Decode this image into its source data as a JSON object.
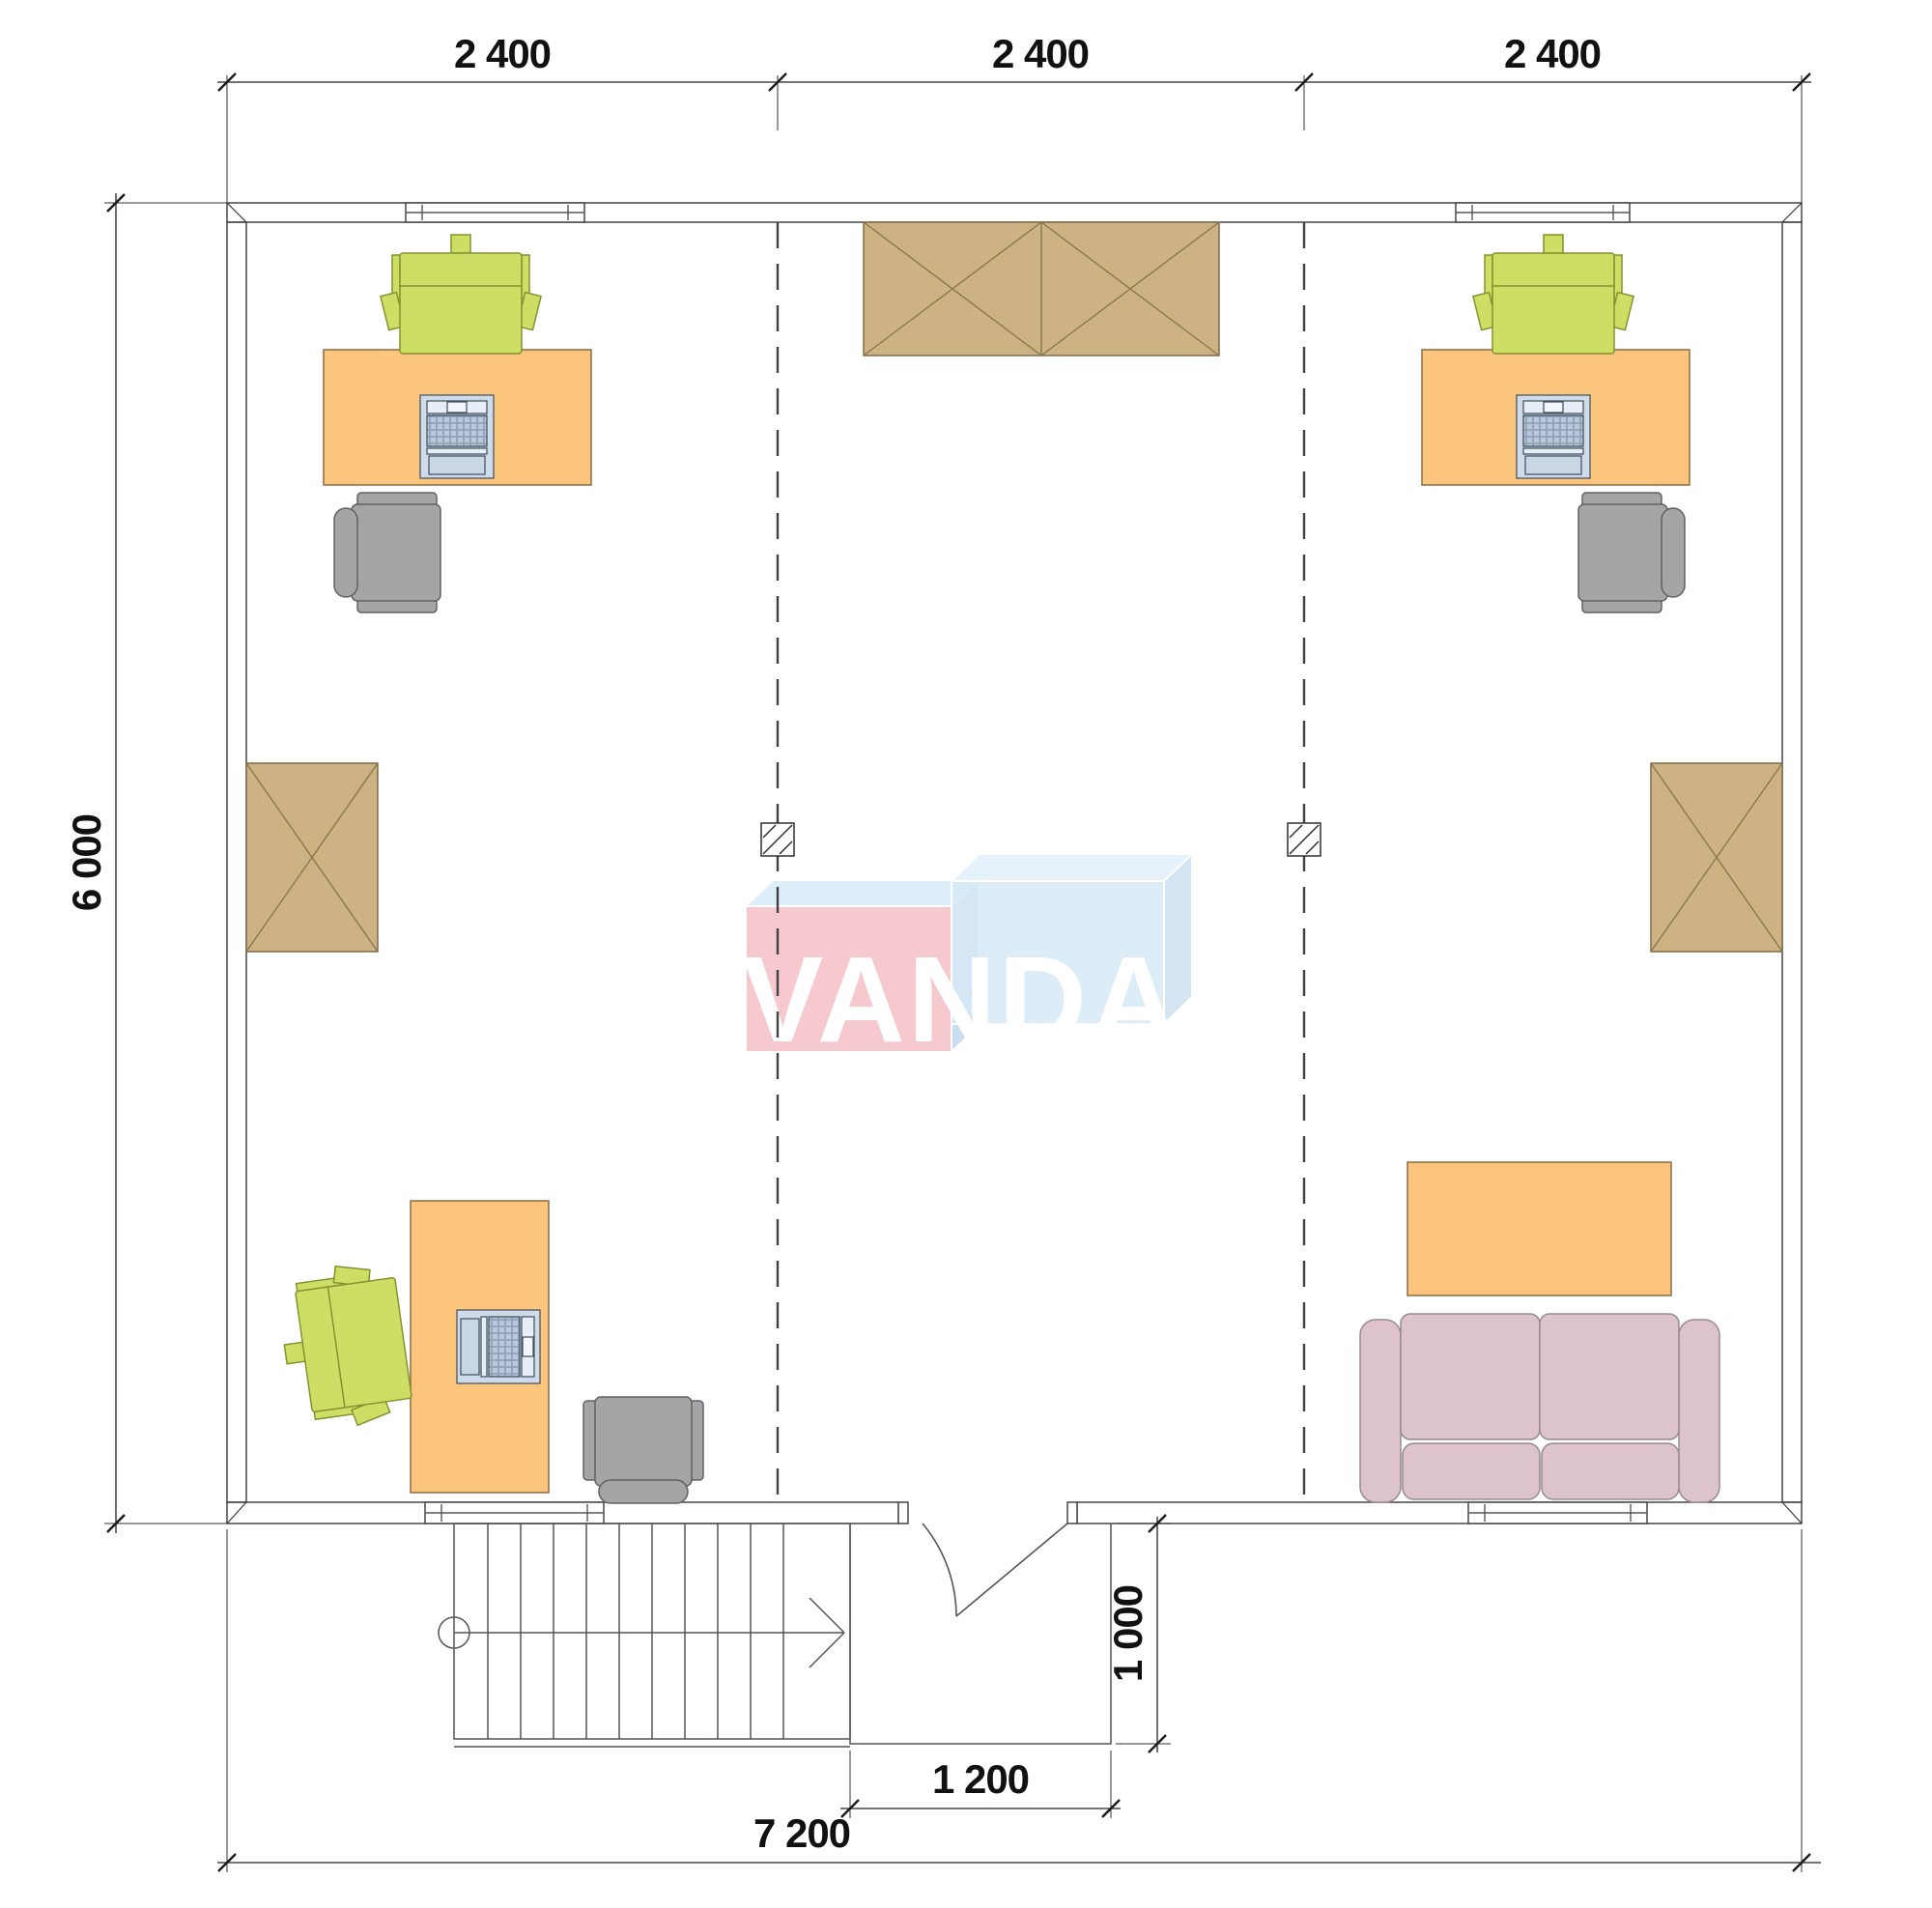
{
  "watermark": {
    "brand": "VANDA"
  },
  "dimensions": {
    "top": [
      "2 400",
      "2 400",
      "2 400"
    ],
    "side_height": "6 000",
    "entry_width": "1 200",
    "entry_depth": "1 000",
    "total_width": "7 200"
  },
  "colors": {
    "wall": "#9b9b9f",
    "desk": "#fcc57d",
    "chair_green": "#cede65",
    "chair_gray": "#a5a5a7",
    "cabinet": "#cdb284",
    "sofa": "#dcc4ca",
    "laptop": "#cfdbe9",
    "laptop_keys": "#b9c8db",
    "laptop_key_gap": "#8fa0b4",
    "column_fill": "#ffffff",
    "logo_pink": "#f6c5cc",
    "logo_blue": "#d3e7f6",
    "logo_blue_side": "#c7dcef",
    "logo_bevel": "#ddeefa",
    "logo_text": "#ffffff",
    "dim_text": "#111111"
  },
  "elements": {
    "workstations": 3,
    "wardrobes": 3,
    "sofas": 1,
    "coffee_tables": 1,
    "columns": 2,
    "windows": 4,
    "stairs": 1,
    "entry_doors": 1
  }
}
